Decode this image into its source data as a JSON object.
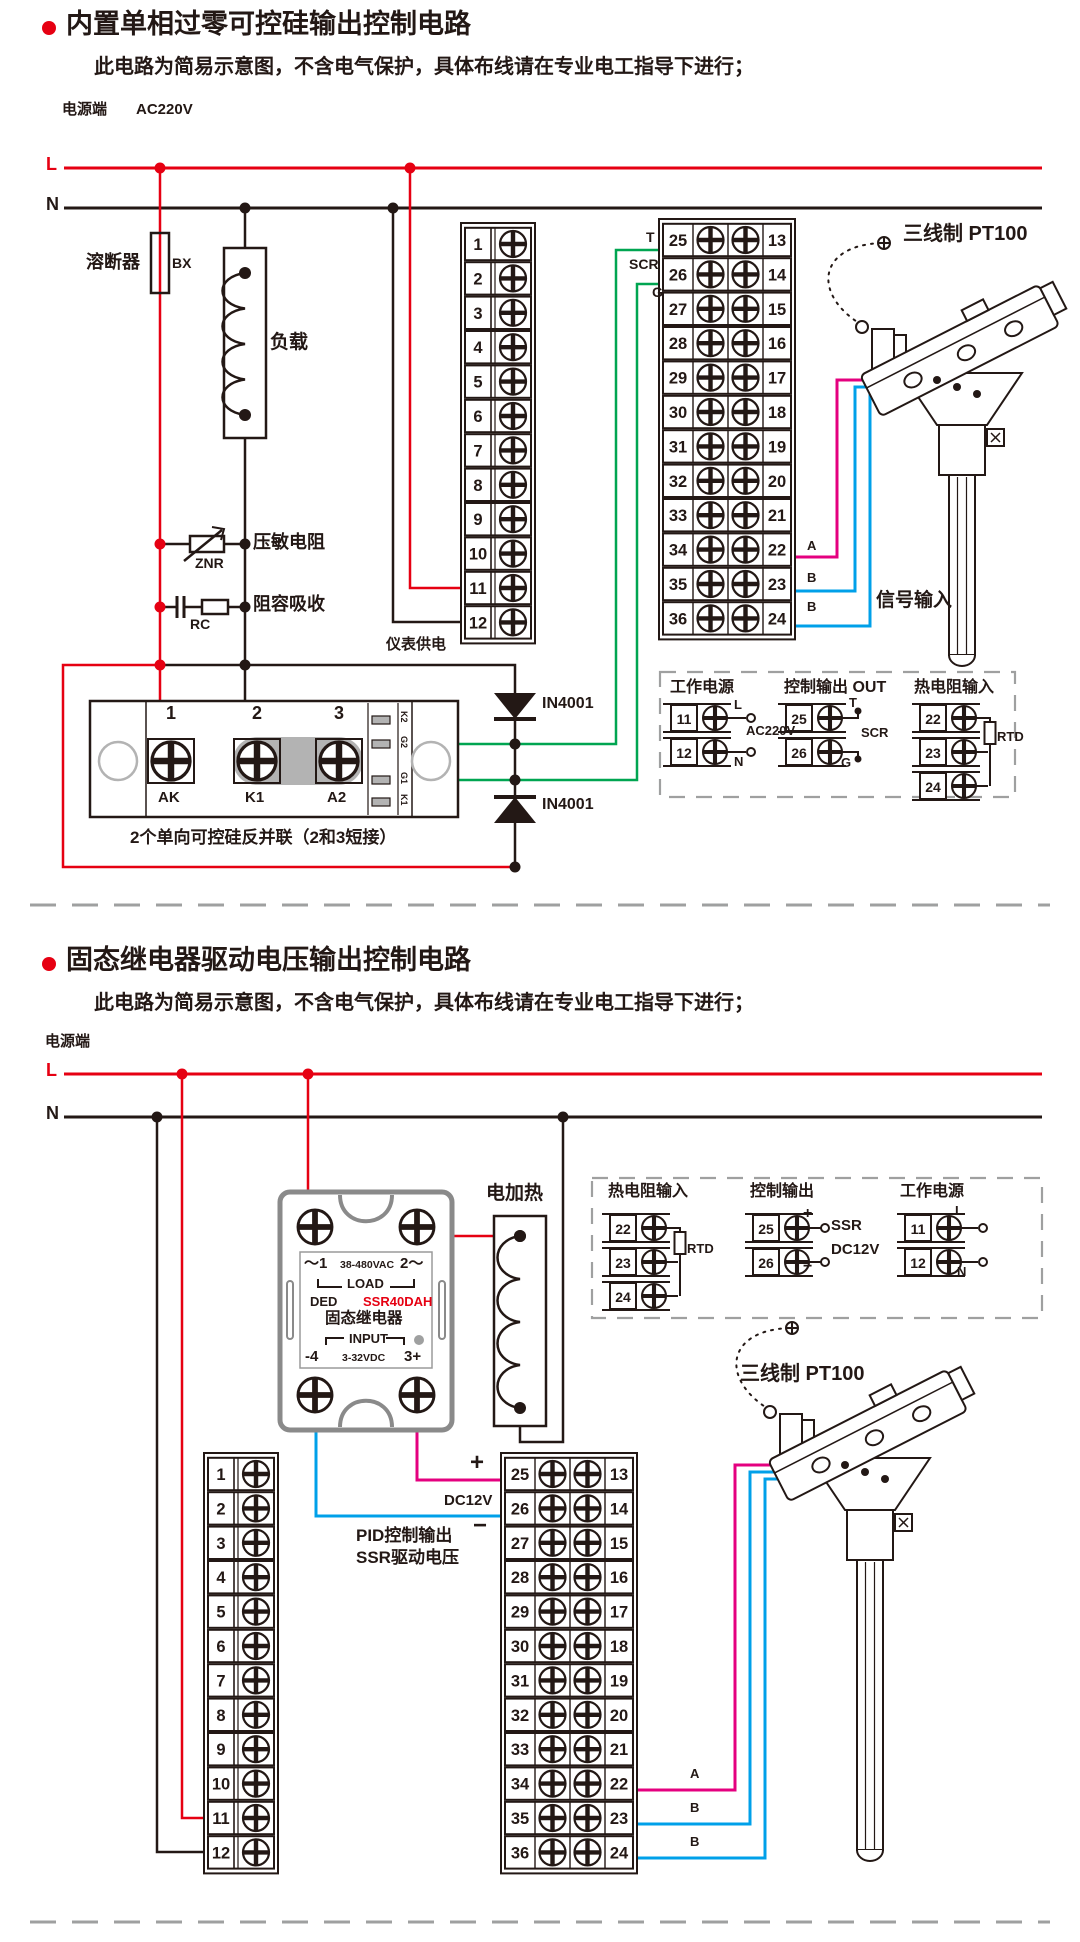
{
  "colors": {
    "red": "#e60012",
    "black": "#231815",
    "green": "#00a551",
    "pink": "#e4007f",
    "blue": "#00a0e9",
    "gray": "#9fa0a0"
  },
  "section1": {
    "title": "内置单相过零可控硅输出控制电路",
    "subtitle": "此电路为简易示意图，不含电气保护，具体布线请在专业电工指导下进行；",
    "power_terminal": "电源端",
    "voltage": "AC220V",
    "line_l": "L",
    "line_n": "N",
    "fuse_label": "溶断器",
    "fuse_code": "BX",
    "load_label": "负载",
    "varistor_label": "压敏电阻",
    "varistor_code": "ZNR",
    "rc_label": "阻容吸收",
    "rc_code": "RC",
    "meter_power": "仪表供电",
    "out_t": "T",
    "out_scr": "SCR",
    "out_g": "G",
    "pt100_label": "三线制 PT100",
    "signal_input": "信号输入",
    "wire_a": "A",
    "wire_b1": "B",
    "wire_b2": "B",
    "diode1": "IN4001",
    "diode2": "IN4001",
    "scr_module": {
      "t1": "1",
      "t2": "2",
      "t3": "3",
      "t1_name": "AK",
      "t2_name": "K1",
      "t3_name": "A2",
      "pads": [
        "K2",
        "G2",
        "G1",
        "K1"
      ],
      "note": "2个单向可控硅反并联（2和3短接）"
    },
    "legend": {
      "power_title": "工作电源",
      "power_rows": [
        "11",
        "12"
      ],
      "power_l": "L",
      "power_n": "N",
      "power_v": "AC220V",
      "out_title": "控制输出 OUT",
      "out_rows": [
        "25",
        "26"
      ],
      "out_t": "T",
      "out_scr": "SCR",
      "out_g": "G",
      "rtd_title": "热电阻输入",
      "rtd_rows": [
        "22",
        "23",
        "24"
      ],
      "rtd_code": "RTD"
    },
    "blocks": {
      "left": [
        "1",
        "2",
        "3",
        "4",
        "5",
        "6",
        "7",
        "8",
        "9",
        "10",
        "11",
        "12"
      ],
      "right_l": [
        "25",
        "26",
        "27",
        "28",
        "29",
        "30",
        "31",
        "32",
        "33",
        "34",
        "35",
        "36"
      ],
      "right_r": [
        "13",
        "14",
        "15",
        "16",
        "17",
        "18",
        "19",
        "20",
        "21",
        "22",
        "23",
        "24"
      ]
    }
  },
  "section2": {
    "title": "固态继电器驱动电压输出控制电路",
    "subtitle": "此电路为简易示意图，不含电气保护，具体布线请在专业电工指导下进行；",
    "power_terminal": "电源端",
    "line_l": "L",
    "line_n": "N",
    "ssr": {
      "line1_l": "～1",
      "line1_m": "38-480VAC",
      "line1_r": "2～",
      "load": "LOAD",
      "ded": "DED",
      "model": "SSR40DAH",
      "name": "固态继电器",
      "input": "INPUT",
      "in_l": "-4",
      "in_m": "3-32VDC",
      "in_r": "3+"
    },
    "heater_label": "电加热",
    "legend": {
      "rtd_title": "热电阻输入",
      "rtd_rows": [
        "22",
        "23",
        "24"
      ],
      "rtd_code": "RTD",
      "out_title": "控制输出",
      "out_rows": [
        "25",
        "26"
      ],
      "out_plus": "+",
      "out_minus": "−",
      "out_ssr": "SSR",
      "out_v": "DC12V",
      "power_title": "工作电源",
      "power_rows": [
        "11",
        "12"
      ],
      "power_l": "L",
      "power_n": "N"
    },
    "dc_plus": "+",
    "dc_label": "DC12V",
    "dc_minus": "−",
    "pid_line1": "PID控制输出",
    "pid_line2": "SSR驱动电压",
    "pt100_label": "三线制 PT100",
    "wire_a": "A",
    "wire_b1": "B",
    "wire_b2": "B",
    "blocks": {
      "left": [
        "1",
        "2",
        "3",
        "4",
        "5",
        "6",
        "7",
        "8",
        "9",
        "10",
        "11",
        "12"
      ],
      "right_l": [
        "25",
        "26",
        "27",
        "28",
        "29",
        "30",
        "31",
        "32",
        "33",
        "34",
        "35",
        "36"
      ],
      "right_r": [
        "13",
        "14",
        "15",
        "16",
        "17",
        "18",
        "19",
        "20",
        "21",
        "22",
        "23",
        "24"
      ]
    }
  }
}
